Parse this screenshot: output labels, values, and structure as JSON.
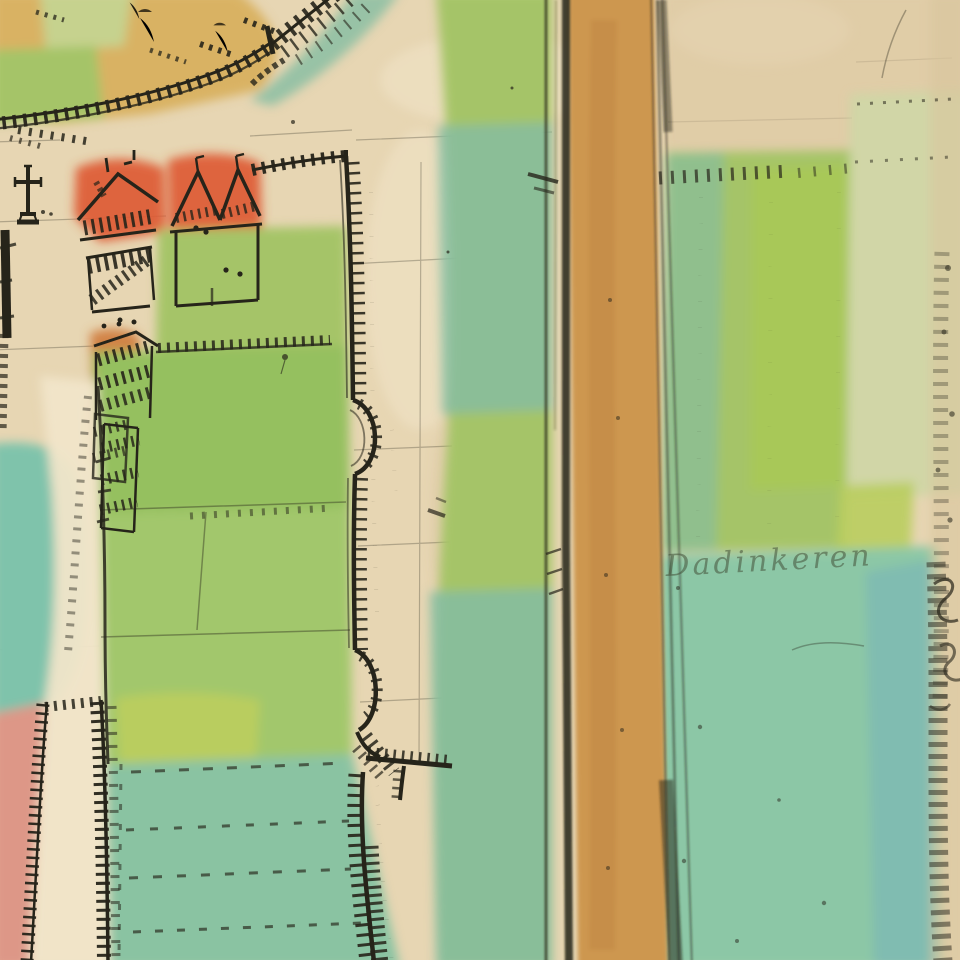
{
  "map": {
    "annotations": {
      "field_name_script": "Dadinkeren"
    },
    "colors": {
      "parchment": "#e7d6b3",
      "parchment_light": "#f1e5c9",
      "parchment_shade": "#d9c49c",
      "ochre": "#d9b264",
      "green_pale": "#c6d28e",
      "green": "#a5c468",
      "green_field": "#95c05e",
      "green_lower": "#a2c76c",
      "green_lime": "#b9cd5e",
      "green_bright": "#a9c955",
      "teal": "#84bda2",
      "teal_meadow": "#8ac3a2",
      "teal_field": "#8cc7a6",
      "teal_blue": "#7db9b4",
      "teal_pond": "#7fc3ab",
      "pink": "#dd9787",
      "red_roof": "#dd5a34",
      "orange_roof": "#cf7a3a",
      "brown_roof": "#a66030",
      "road": "#cd9750",
      "road_dark": "#b97f3e",
      "road_edge": "#463a1e",
      "road_line": "#42381f",
      "fuzz": "#8f8a74",
      "ink": "#26241a",
      "ink_faint": "#8a7752",
      "ink_teal": "#4a6a5e",
      "script": "#44503a"
    }
  }
}
